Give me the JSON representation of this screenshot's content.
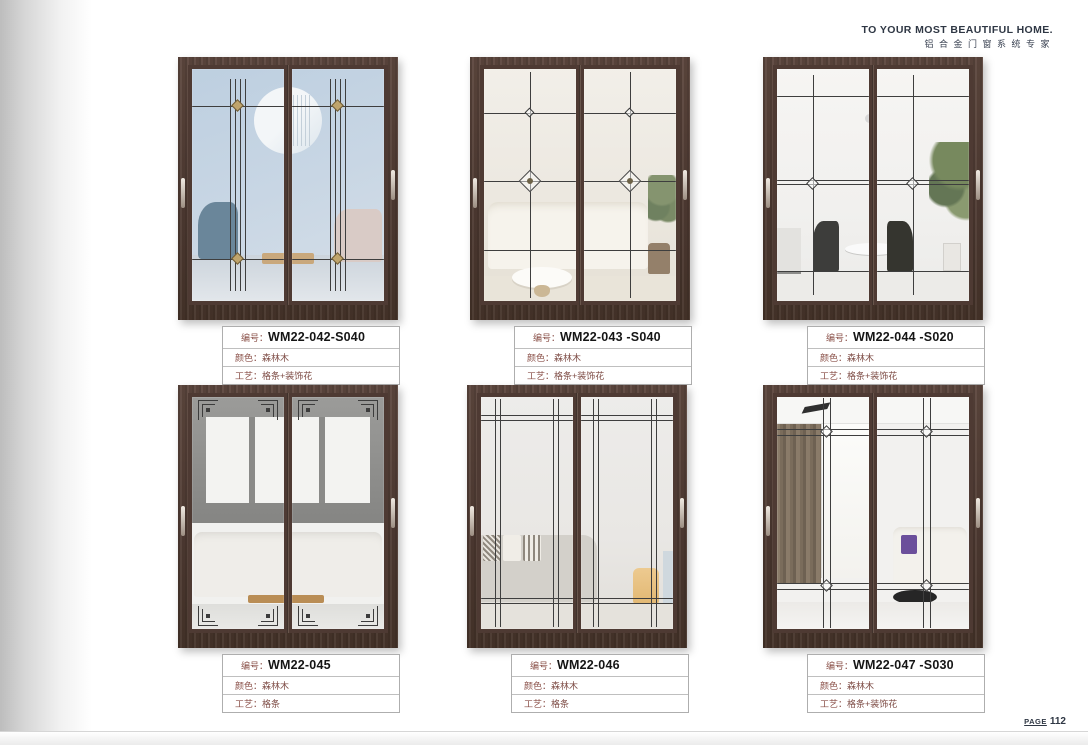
{
  "header": {
    "slogan_en": "TO YOUR MOST BEAUTIFUL HOME.",
    "slogan_cn": "铝合金门窗系统专家"
  },
  "footer": {
    "page_label": "PAGE",
    "page_number": "112"
  },
  "field_labels": {
    "code": "编号：",
    "color": "颜色：",
    "craft": "工艺："
  },
  "products": [
    {
      "code": "WM22-042-S040",
      "color": "森林木",
      "craft": "格条+装饰花",
      "scene": "blue-living-room"
    },
    {
      "code": "WM22-043 -S040",
      "color": "森林木",
      "craft": "格条+装饰花",
      "scene": "cream-living-room"
    },
    {
      "code": "WM22-044 -S020",
      "color": "森林木",
      "craft": "格条+装饰花",
      "scene": "dining-room"
    },
    {
      "code": "WM22-045",
      "color": "森林木",
      "craft": "格条",
      "scene": "grey-lounge"
    },
    {
      "code": "WM22-046",
      "color": "森林木",
      "craft": "格条",
      "scene": "fabric-sofa-room"
    },
    {
      "code": "WM22-047 -S030",
      "color": "森林木",
      "craft": "格条+装饰花",
      "scene": "curtain-lounge"
    }
  ],
  "palette": {
    "door_frame_wood": "#4e3a33",
    "label_text_red": "#7d4b44",
    "heading_navy": "#2f3744",
    "page_background": "#ffffff"
  }
}
